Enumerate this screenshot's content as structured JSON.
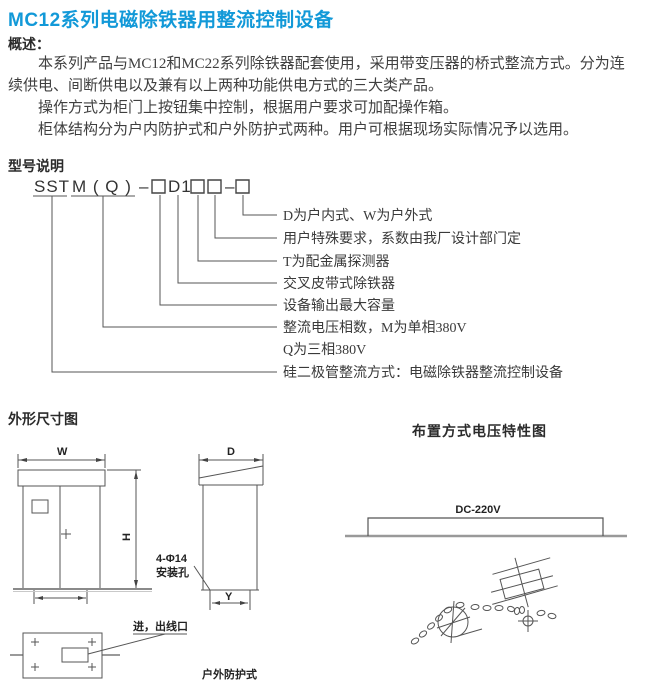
{
  "title": "MC12系列电磁除铁器用整流控制设备",
  "colors": {
    "title_blue": "#1299d8",
    "line_dark": "#4a4a4a",
    "line_gray": "#999999"
  },
  "overview": {
    "heading": "概述：",
    "paragraphs": [
      "本系列产品与MC12和MC22系列除铁器配套使用，采用带变压器的桥式整流方式。分为连续供电、间断供电以及兼有以上两种功能供电方式的三大类产品。",
      "操作方式为柜门上按钮集中控制，根据用户要求可加配操作箱。",
      "柜体结构分为户内防护式和户外防护式两种。用户可根据现场实际情况予以选用。"
    ]
  },
  "model": {
    "heading": "型号说明",
    "code": {
      "s1": "SST",
      "s2": "M ( Q )",
      "dash1": "–",
      "d1": "D1",
      "dash2": "–"
    },
    "labels": [
      "D为户内式、W为户外式",
      "用户特殊要求，系数由我厂设计部门定",
      "T为配金属探测器",
      "交叉皮带式除铁器",
      "设备输出最大容量",
      "整流电压相数，M为单相380V",
      "Q为三相380V",
      "硅二极管整流方式：电磁除铁器整流控制设备"
    ]
  },
  "dimension_figure": {
    "heading": "外形尺寸图",
    "width_label": "W",
    "height_label": "H",
    "depth_label": "D",
    "foot_label": "Y",
    "mounting_hole_line1": "4-Φ14",
    "mounting_hole_line2": "安装孔",
    "ports_label": "进，出线口",
    "outdoor_label": "户外防护式"
  },
  "voltage_figure": {
    "heading": "布置方式电压特性图",
    "dc_label": "DC-220V"
  }
}
